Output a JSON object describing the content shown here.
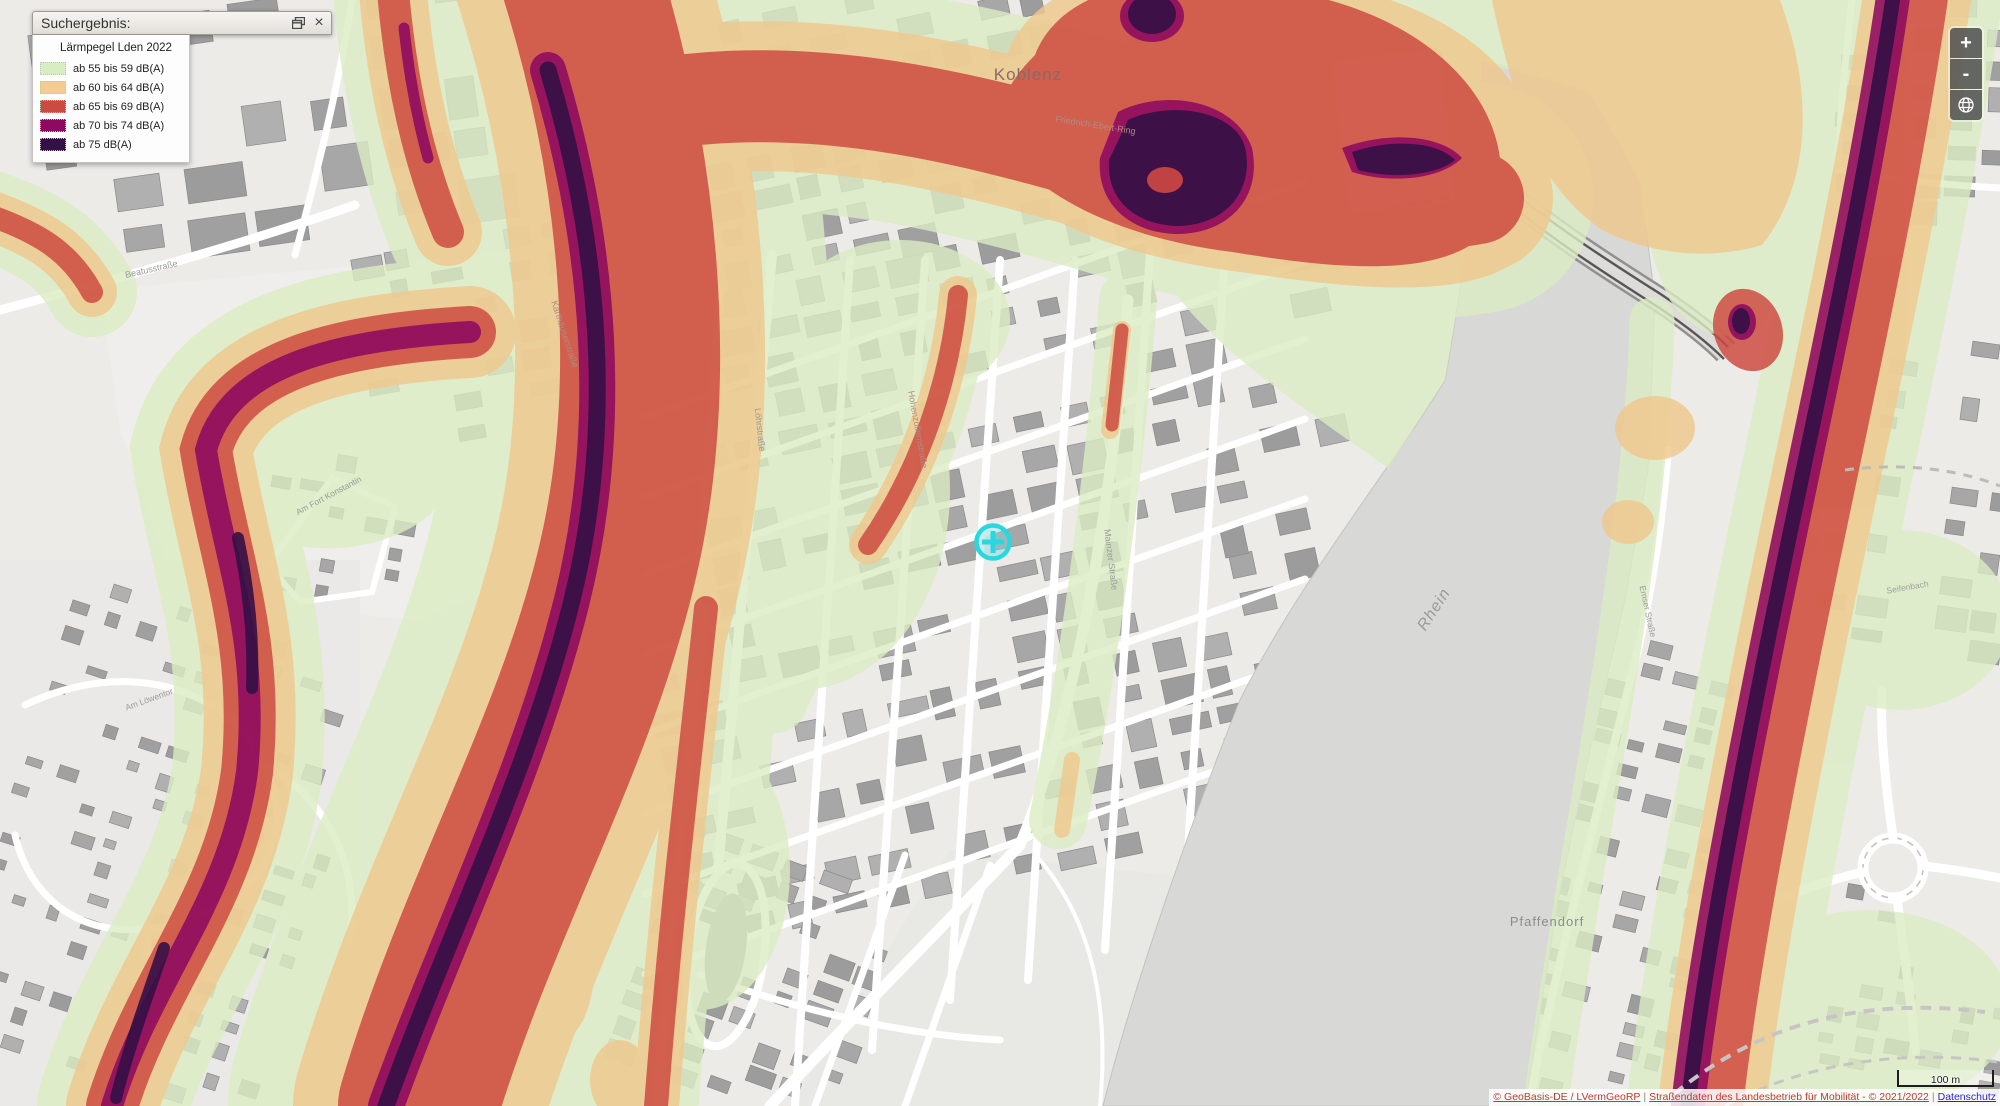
{
  "window": {
    "title": "Suchergebnis:",
    "close_symbol": "×"
  },
  "legend": {
    "title": "Lärmpegel Lden 2022",
    "items": [
      {
        "label": "ab 55 bis 59 dB(A)",
        "color": "#d8edc1"
      },
      {
        "label": "ab 60 bis 64 dB(A)",
        "color": "#f2cc90"
      },
      {
        "label": "ab 65 bis 69 dB(A)",
        "color": "#cb4a41"
      },
      {
        "label": "ab 70 bis 74 dB(A)",
        "color": "#8d0a60"
      },
      {
        "label": "ab 75 dB(A)",
        "color": "#341046"
      }
    ]
  },
  "zoom_controls": {
    "zoom_in_label": "+",
    "zoom_out_label": "-"
  },
  "scale_bar": {
    "label": "100 m"
  },
  "attribution": {
    "source_link": "© GeoBasis-DE / LVermGeoRP",
    "separator": "|",
    "roads_text": "Straßendaten des Landesbetrieb für Mobilität - © 2021/2022",
    "privacy_link": "Datenschutz",
    "link_color": "#c0392f",
    "privacy_color": "#2424d8"
  },
  "marker": {
    "color": "#29d8de"
  },
  "map": {
    "place_labels": [
      {
        "text": "Koblenz",
        "x": 1028,
        "y": 80,
        "size": 17,
        "color": "#8a6a66",
        "rotate": 0,
        "italic": false
      },
      {
        "text": "Rhein",
        "x": 1438,
        "y": 612,
        "size": 16,
        "color": "#9b9b99",
        "rotate": -57,
        "italic": true
      },
      {
        "text": "Pfaffendorf",
        "x": 1547,
        "y": 926,
        "size": 13,
        "color": "#8c8c8a",
        "rotate": 0,
        "italic": false
      }
    ],
    "street_labels": [
      {
        "text": "Beatusstraße",
        "x": 152,
        "y": 272,
        "size": 9,
        "color": "#9a9a98",
        "rotate": -13
      },
      {
        "text": "Friedrich-Ebert-Ring",
        "x": 1095,
        "y": 128,
        "size": 9,
        "color": "#b08a82",
        "rotate": 9
      },
      {
        "text": "Hohenzollernstraße",
        "x": 915,
        "y": 430,
        "size": 9,
        "color": "#b08a82",
        "rotate": 80
      },
      {
        "text": "Mainzer Straße",
        "x": 1108,
        "y": 560,
        "size": 9,
        "color": "#9a9a98",
        "rotate": 83
      },
      {
        "text": "Löhrstraße",
        "x": 757,
        "y": 430,
        "size": 9,
        "color": "#9a9a98",
        "rotate": 84
      },
      {
        "text": "Am Fort Konstantin",
        "x": 330,
        "y": 498,
        "size": 8.5,
        "color": "#9a9a98",
        "rotate": -28
      },
      {
        "text": "Emser Straße",
        "x": 1645,
        "y": 612,
        "size": 8.5,
        "color": "#9a9a98",
        "rotate": 78
      },
      {
        "text": "Seifenbach",
        "x": 1908,
        "y": 590,
        "size": 8.5,
        "color": "#a0a09e",
        "rotate": -10
      },
      {
        "text": "Am Löwentor",
        "x": 150,
        "y": 702,
        "size": 8.5,
        "color": "#9a9a98",
        "rotate": -20
      },
      {
        "text": "Karthäuserstraße",
        "x": 562,
        "y": 335,
        "size": 9,
        "color": "#b08a82",
        "rotate": 72
      }
    ]
  }
}
